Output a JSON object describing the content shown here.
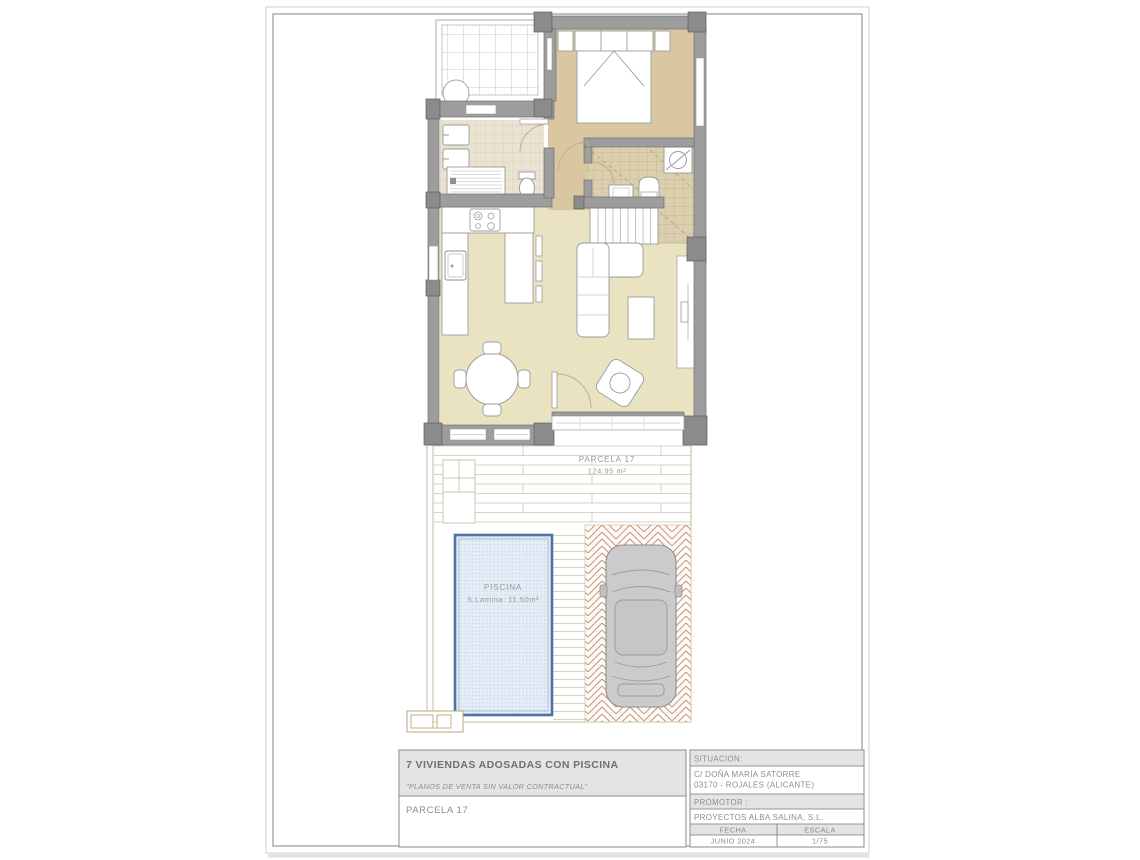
{
  "sheet": {
    "plan_labels": {
      "parcel_name": "PARCELA 17",
      "parcel_area": "124.95 m²",
      "pool_name": "PISCINA",
      "pool_area": "S.Lamina: 11.50m²"
    },
    "title_block": {
      "project_title": "7 VIVIENDAS ADOSADAS CON PISCINA",
      "disclaimer": "\"PLANOS DE VENTA SIN VALOR CONTRACTUAL\"",
      "parcel": "PARCELA 17",
      "situacion_label": "SITUACION:",
      "address_line1": "C/ DOÑA MARÍA SATORRE",
      "address_line2": "03170 - ROJALES (ALICANTE)",
      "promotor_label": "PROMOTOR :",
      "promotor_value": "PROYECTOS ALBA SALINA, S.L.",
      "fecha_label": "FECHA",
      "fecha_value": "JUNIO 2024",
      "escala_label": "ESCALA",
      "escala_value": "1/75"
    },
    "colors": {
      "wall": "#9d9d9d",
      "floor_bedroom": "#d9c7a1",
      "floor_living": "#e9e3c2",
      "pool_border": "#51719f",
      "pool_fill": "#e4edf6",
      "paving_brick": "#c58a70",
      "outline_sand": "#c0b795",
      "titleblock_header": "#e4e4e4",
      "text_gray": "#8d8d8d"
    }
  }
}
